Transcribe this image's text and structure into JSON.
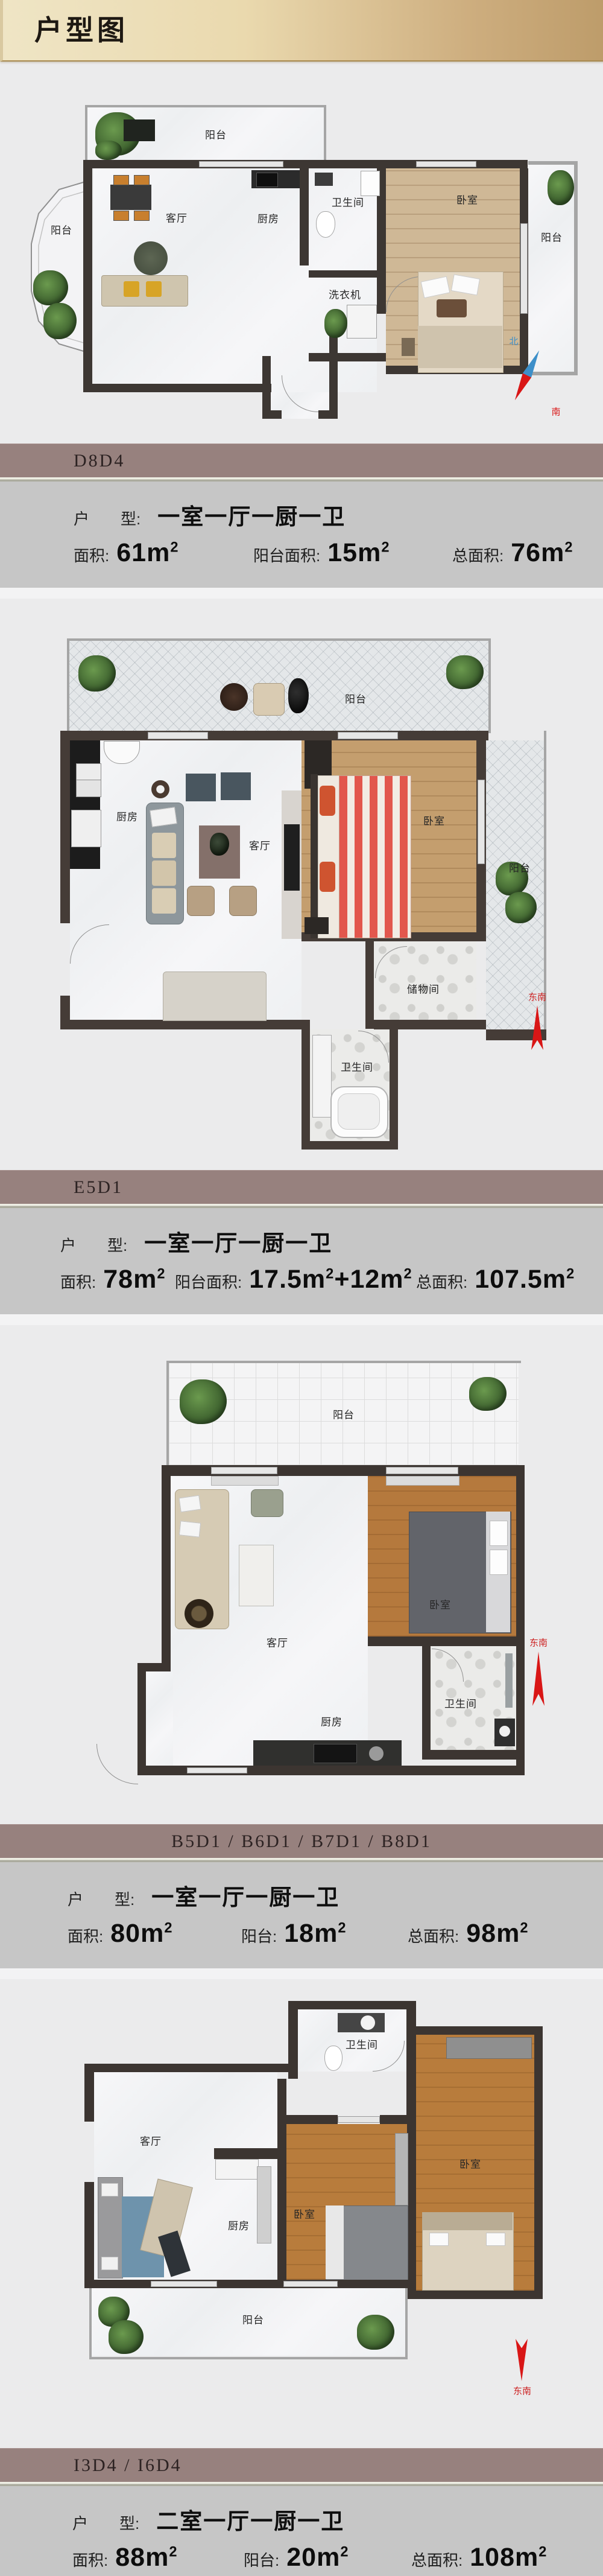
{
  "theme": {
    "header_gradient_left": "#efe5c5",
    "header_gradient_right": "#bd9c6a",
    "page_bg": "#ebebec",
    "section_bar_bg": "#97817e",
    "panel_bg": "#c6c6c6",
    "wall_color": "#3d3733",
    "compass_red": "#d91616",
    "compass_blue": "#3d8fc9"
  },
  "header": {
    "title": "户型图"
  },
  "sections": [
    {
      "code": "D8D4",
      "type_label": "户　　型:",
      "type_value": "一室一厅一厨一卫",
      "metrics": [
        {
          "label": "面积:",
          "value": "61m²"
        },
        {
          "label": "阳台面积:",
          "value": "15m²"
        },
        {
          "label": "总面积:",
          "value": "76m²"
        }
      ],
      "plan": {
        "labels": {
          "balcony_top": "阳台",
          "balcony_left": "阳台",
          "living": "客厅",
          "kitchen": "厨房",
          "bath": "卫生间",
          "washer": "洗衣机",
          "bedroom": "卧室",
          "balcony_right": "阳台"
        },
        "compass": {
          "north": "北",
          "south": "南"
        }
      }
    },
    {
      "code": "E5D1",
      "type_label": "户　　型:",
      "type_value": "一室一厅一厨一卫",
      "metrics": [
        {
          "label": "面积:",
          "value": "78m²"
        },
        {
          "label": "阳台面积:",
          "value": "17.5m²+12m²"
        },
        {
          "label": "总面积:",
          "value": "107.5m²"
        }
      ],
      "plan": {
        "labels": {
          "balcony_top": "阳台",
          "kitchen": "厨房",
          "living": "客厅",
          "bedroom": "卧室",
          "balcony_right": "阳台",
          "storage": "储物间",
          "bath": "卫生间"
        },
        "compass": {
          "se": "东南"
        }
      }
    },
    {
      "code": "B5D1 / B6D1 / B7D1 / B8D1",
      "type_label": "户　　型:",
      "type_value": "一室一厅一厨一卫",
      "metrics": [
        {
          "label": "面积:",
          "value": "80m²"
        },
        {
          "label": "阳台:",
          "value": "18m²"
        },
        {
          "label": "总面积:",
          "value": "98m²"
        }
      ],
      "plan": {
        "labels": {
          "balcony_top": "阳台",
          "living": "客厅",
          "bedroom": "卧室",
          "kitchen": "厨房",
          "bath": "卫生间"
        },
        "compass": {
          "se": "东南"
        }
      }
    },
    {
      "code": "I3D4 / I6D4",
      "type_label": "户　　型:",
      "type_value": "二室一厅一厨一卫",
      "metrics": [
        {
          "label": "面积:",
          "value": "88m²"
        },
        {
          "label": "阳台:",
          "value": "20m²"
        },
        {
          "label": "总面积:",
          "value": "108m²"
        }
      ],
      "plan": {
        "labels": {
          "bath": "卫生间",
          "living": "客厅",
          "kitchen": "厨房",
          "bedroom_small": "卧室",
          "bedroom_large": "卧室",
          "balcony_bottom": "阳台"
        },
        "compass": {
          "se": "东南"
        }
      }
    }
  ]
}
